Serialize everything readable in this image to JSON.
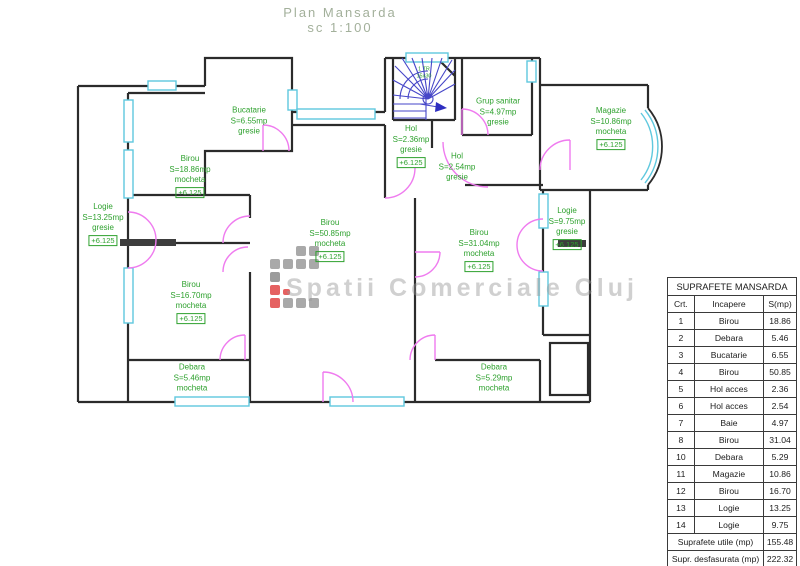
{
  "title": {
    "line1": "Plan Mansarda",
    "line2": "sc 1:100"
  },
  "watermark": {
    "text": "Spatii Comerciale Cluj"
  },
  "stairs": {
    "label_line1": "1 TR",
    "label_line2": "15x30"
  },
  "colors": {
    "wall": "#2b2b2b",
    "window": "#5fc8de",
    "door": "#ef7bef",
    "stair": "#4646c8",
    "label_green": "#2ea12e",
    "watermark_red": "#e04545",
    "watermark_gray": "#9a9a9a"
  },
  "rooms": {
    "bucatarie": {
      "name": "Bucatarie",
      "area": "S=6.55mp",
      "finish": "gresie"
    },
    "birou_1886": {
      "name": "Birou",
      "area": "S=18.86mp",
      "finish": "mocheta",
      "level": "+6.125"
    },
    "logie_left": {
      "name": "Logie",
      "area": "S=13.25mp",
      "finish": "gresie",
      "level": "+6.125"
    },
    "birou_5085": {
      "name": "Birou",
      "area": "S=50.85mp",
      "finish": "mocheta",
      "level": "+6.125"
    },
    "birou_1670": {
      "name": "Birou",
      "area": "S=16.70mp",
      "finish": "mocheta",
      "level": "+6.125"
    },
    "debara_546": {
      "name": "Debara",
      "area": "S=5.46mp",
      "finish": "mocheta"
    },
    "hol_236": {
      "name": "Hol",
      "area": "S=2.36mp",
      "finish": "gresie",
      "level": "+6.125"
    },
    "hol_254": {
      "name": "Hol",
      "area": "S=2.54mp",
      "finish": "gresie"
    },
    "grup_sanitar": {
      "name": "Grup sanitar",
      "area": "S=4.97mp",
      "finish": "gresie"
    },
    "magazie": {
      "name": "Magazie",
      "area": "S=10.86mp",
      "finish": "mocheta",
      "level": "+6.125"
    },
    "birou_3104": {
      "name": "Birou",
      "area": "S=31.04mp",
      "finish": "mocheta",
      "level": "+6.125"
    },
    "logie_right": {
      "name": "Logie",
      "area": "S=9.75mp",
      "finish": "gresie",
      "level": "+6.125"
    },
    "debara_529": {
      "name": "Debara",
      "area": "S=5.29mp",
      "finish": "mocheta"
    }
  },
  "table": {
    "title": "SUPRAFETE MANSARDA",
    "columns": {
      "crt": "Crt.",
      "incapere": "Incapere",
      "smp": "S(mp)"
    },
    "rows": [
      {
        "crt": "1",
        "incapere": "Birou",
        "smp": "18.86"
      },
      {
        "crt": "2",
        "incapere": "Debara",
        "smp": "5.46"
      },
      {
        "crt": "3",
        "incapere": "Bucatarie",
        "smp": "6.55"
      },
      {
        "crt": "4",
        "incapere": "Birou",
        "smp": "50.85"
      },
      {
        "crt": "5",
        "incapere": "Hol acces",
        "smp": "2.36"
      },
      {
        "crt": "6",
        "incapere": "Hol acces",
        "smp": "2.54"
      },
      {
        "crt": "7",
        "incapere": "Baie",
        "smp": "4.97"
      },
      {
        "crt": "8",
        "incapere": "Birou",
        "smp": "31.04"
      },
      {
        "crt": "10",
        "incapere": "Debara",
        "smp": "5.29"
      },
      {
        "crt": "11",
        "incapere": "Magazie",
        "smp": "10.86"
      },
      {
        "crt": "12",
        "incapere": "Birou",
        "smp": "16.70"
      },
      {
        "crt": "13",
        "incapere": "Logie",
        "smp": "13.25"
      },
      {
        "crt": "14",
        "incapere": "Logie",
        "smp": "9.75"
      }
    ],
    "footer": [
      {
        "label": "Suprafete utile (mp)",
        "value": "155.48"
      },
      {
        "label": "Supr. desfasurata (mp)",
        "value": "222.32"
      }
    ]
  }
}
